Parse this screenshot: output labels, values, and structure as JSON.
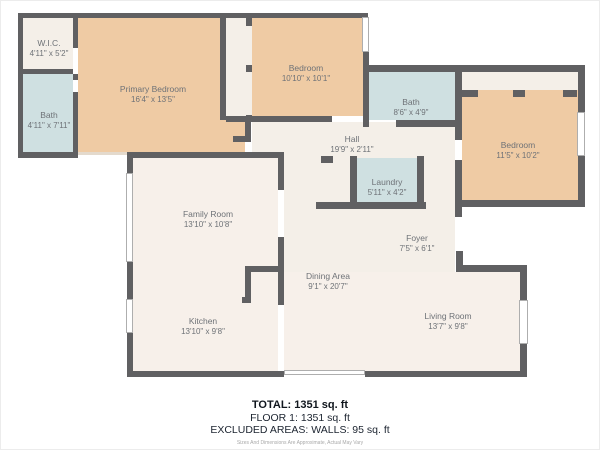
{
  "plan": {
    "rooms": {
      "wic": {
        "name": "W.I.C.",
        "dims": "4'11\" x 5'2\""
      },
      "bath_main": {
        "name": "Bath",
        "dims": "4'11\" x 7'11\""
      },
      "primary_bedroom": {
        "name": "Primary Bedroom",
        "dims": "16'4\" x 13'5\""
      },
      "bedroom_2": {
        "name": "Bedroom",
        "dims": "10'10\" x 10'1\""
      },
      "bath_2": {
        "name": "Bath",
        "dims": "8'6\" x 4'9\""
      },
      "bedroom_3": {
        "name": "Bedroom",
        "dims": "11'5\" x 10'2\""
      },
      "hall": {
        "name": "Hall",
        "dims": "19'9\" x 2'11\""
      },
      "laundry": {
        "name": "Laundry",
        "dims": "5'11\" x 4'2\""
      },
      "family_room": {
        "name": "Family Room",
        "dims": "13'10\" x 10'8\""
      },
      "foyer": {
        "name": "Foyer",
        "dims": "7'5\" x 6'1\""
      },
      "dining_area": {
        "name": "Dining Area",
        "dims": "9'1\" x 20'7\""
      },
      "kitchen": {
        "name": "Kitchen",
        "dims": "13'10\" x 9'8\""
      },
      "living_room": {
        "name": "Living Room",
        "dims": "13'7\" x 9'8\""
      }
    },
    "summary": {
      "total": "TOTAL: 1351 sq. ft",
      "floor": "FLOOR 1: 1351 sq. ft",
      "excluded": "EXCLUDED AREAS: WALLS: 95 sq. ft",
      "disclaimer": "Sizes And Dimensions Are Approximate, Actual May Vary"
    },
    "colors": {
      "wall": "#606062",
      "bedroom_fill": "#efcba4",
      "bath_fill": "#cfe0e1",
      "corridor_fill": "#f4efe8",
      "living_fill": "#f7f0ea",
      "label_text": "#6e7277",
      "summary_text": "#1c2430"
    }
  }
}
